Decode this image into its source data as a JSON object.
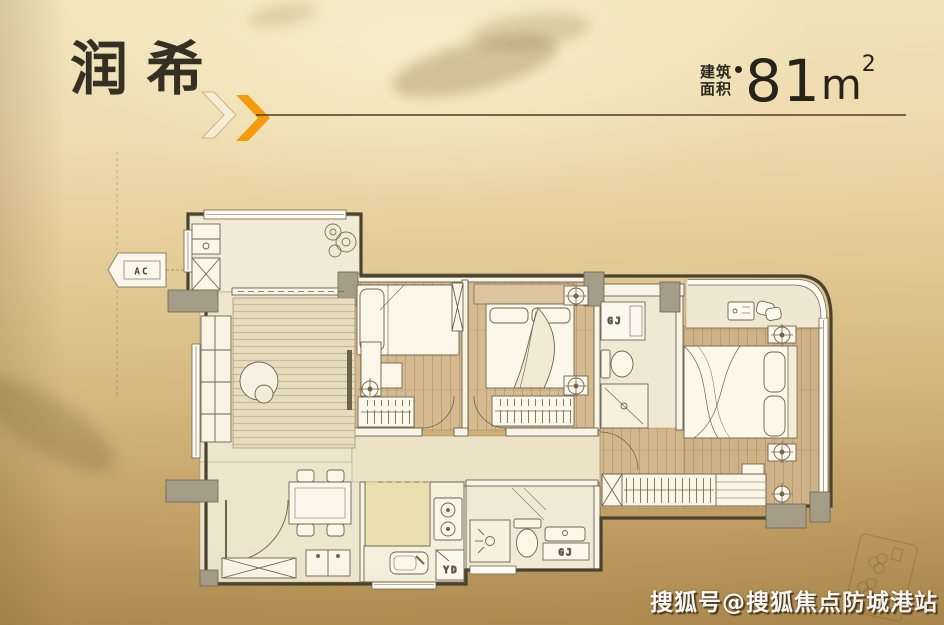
{
  "header": {
    "title": "润希",
    "area_label_line1": "建筑",
    "area_label_line2": "面积",
    "area_value": "81",
    "area_unit": "m",
    "area_superscript": "2"
  },
  "floor_plan": {
    "labels": {
      "ac_tag": "AC",
      "master_bath_cabinet": "GJ",
      "guest_bath_cabinet": "GJ",
      "kitchen_duct": "YD"
    }
  },
  "watermark": "搜狐号@搜狐焦点防城港站",
  "colors": {
    "accent_orange": "#F49B0C",
    "title_ink": "#353024",
    "divider_line": "#52442C",
    "wall_outline": "#49422F",
    "column_gray": "#A49D88",
    "floor_cream": "#EEE5CD",
    "floor_wood": "#D5BB8F",
    "watermark_text": "#FFFFFF",
    "background_top": "#F2E4BB",
    "background_bottom": "#AD8A4E"
  }
}
